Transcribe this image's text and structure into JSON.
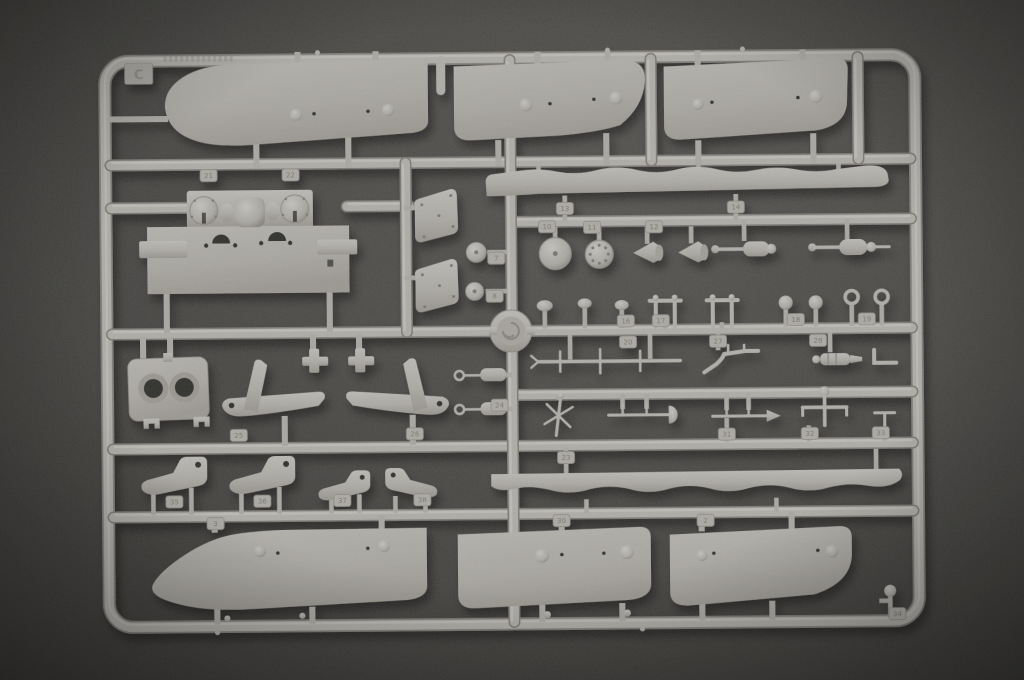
{
  "scene": {
    "description": "Photograph of an injection-molded light-gray plastic model kit sprue (parts runner) for a warship model, lying on a dark gray textured surface",
    "surface": "dark charcoal flocked board",
    "lighting": "soft top light, parts cast small shadows down-right"
  },
  "sprue": {
    "letter": "C",
    "tags": [
      "21",
      "22",
      "13",
      "14",
      "7",
      "8",
      "10",
      "11",
      "12",
      "16",
      "17",
      "18",
      "19",
      "20",
      "27",
      "28",
      "24",
      "25",
      "26",
      "31",
      "32",
      "33",
      "23",
      "35",
      "36",
      "37",
      "38",
      "3",
      "30",
      "2",
      "34"
    ],
    "parts": [
      "hull side panel upper bow",
      "hull side panel upper mid",
      "hull side panel upper stern",
      "superstructure bulkhead with two turret rings",
      "armored shield plate x2",
      "wavy hull strake x2",
      "porthole disc",
      "bolted hatch disc",
      "small disc x2",
      "ventilator horn x2",
      "windlass assembly x2",
      "cable reel hub",
      "mushroom bollard x3",
      "double bollard x2",
      "ball-head post x2",
      "ring-head post x2",
      "yard with crossbars",
      "bent pipe",
      "winch cylinder",
      "L bracket",
      "flag pole with cross spars",
      "rod with dome",
      "rod with spear tip",
      "anchor T-post",
      "small T-post",
      "cylinder rod x2",
      "crane arm x2",
      "mounting plate with two holes",
      "davit bracket x4",
      "hull side panel lower bow",
      "hull side panel lower mid",
      "hull side panel lower stern",
      "ball-top stanchion"
    ]
  },
  "colors": {
    "plastic": "#d6d3cb",
    "plastic_highlight": "#ebe9e3",
    "plastic_shadow": "#94908a",
    "background_center": "#5c5a56",
    "background_edge": "#3a3835",
    "cast_shadow": "#000000"
  }
}
